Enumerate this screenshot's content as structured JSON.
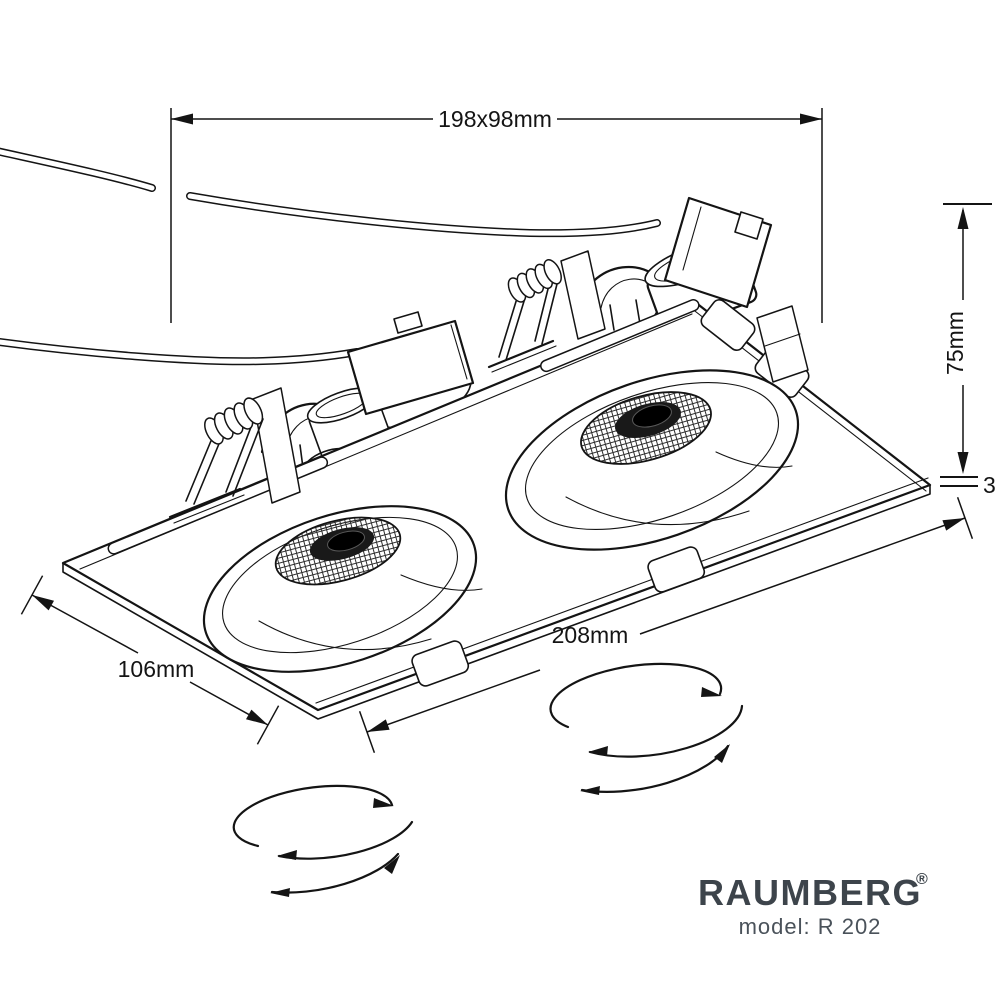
{
  "page": {
    "background": "#ffffff"
  },
  "dimensions": {
    "cutout": "198x98mm",
    "depth": "75mm",
    "plate_thickness": "3",
    "length": "208mm",
    "width": "106mm"
  },
  "brand": {
    "name": "RAUMBERG",
    "registered_mark": "®",
    "model": "model: R 202"
  },
  "colors": {
    "line": "#141414",
    "brand_text": "#3d444b",
    "model_text": "#4a525a"
  },
  "drawing": {
    "type": "technical-line-drawing",
    "subject": "dual recessed gimbal downlight with mounting plate, spring clips, power cables and rotation arrows"
  }
}
